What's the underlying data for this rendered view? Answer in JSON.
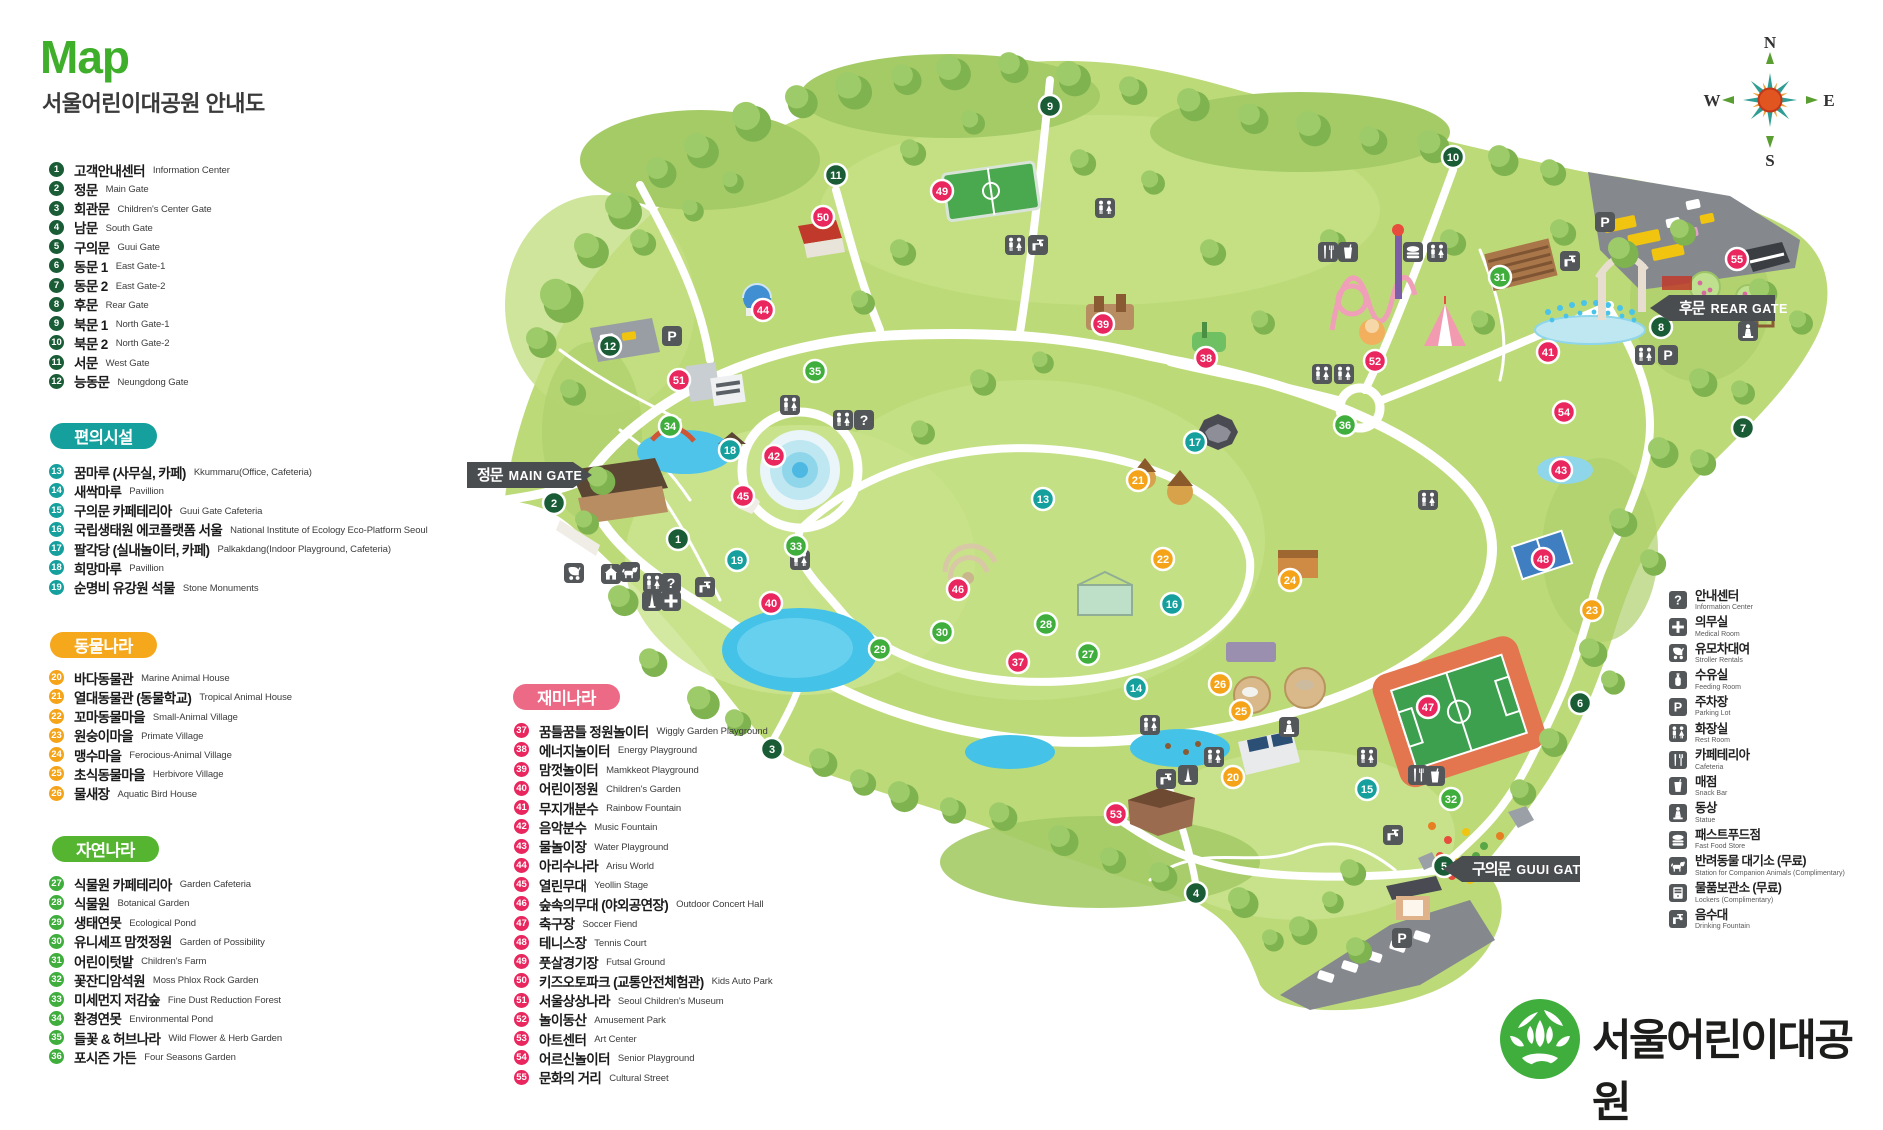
{
  "header": {
    "title": "Map",
    "subtitle": "서울어린이대공원 안내도"
  },
  "logo_text": "서울어린이대공원",
  "compass": {
    "n": "N",
    "e": "E",
    "s": "S",
    "w": "W"
  },
  "icon_glyphs": {
    "question": "?",
    "p": "P"
  },
  "group_colors": {
    "gate": "#1a5c36",
    "conv": "#16a09d",
    "animal": "#f5a41a",
    "nature": "#3fae3c",
    "fun": "#e9265e"
  },
  "sections": [
    {
      "id": "gates",
      "label": null,
      "color": "#1a5c36",
      "items": [
        {
          "n": 1,
          "ko": "고객안내센터",
          "en": "Information Center"
        },
        {
          "n": 2,
          "ko": "정문",
          "en": "Main Gate"
        },
        {
          "n": 3,
          "ko": "회관문",
          "en": "Children's Center Gate"
        },
        {
          "n": 4,
          "ko": "남문",
          "en": "South Gate"
        },
        {
          "n": 5,
          "ko": "구의문",
          "en": "Guui Gate"
        },
        {
          "n": 6,
          "ko": "동문 1",
          "en": "East Gate-1"
        },
        {
          "n": 7,
          "ko": "동문 2",
          "en": "East Gate-2"
        },
        {
          "n": 8,
          "ko": "후문",
          "en": "Rear Gate"
        },
        {
          "n": 9,
          "ko": "북문 1",
          "en": "North Gate-1"
        },
        {
          "n": 10,
          "ko": "북문 2",
          "en": "North Gate-2"
        },
        {
          "n": 11,
          "ko": "서문",
          "en": "West Gate"
        },
        {
          "n": 12,
          "ko": "능동문",
          "en": "Neungdong Gate"
        }
      ]
    },
    {
      "id": "convenience",
      "label": "편의시설",
      "color": "#16a09d",
      "items": [
        {
          "n": 13,
          "ko": "꿈마루 (사무실, 카페)",
          "en": "Kkummaru(Office, Cafeteria)"
        },
        {
          "n": 14,
          "ko": "새싹마루",
          "en": "Pavillion"
        },
        {
          "n": 15,
          "ko": "구의문 카페테리아",
          "en": "Guui Gate Cafeteria"
        },
        {
          "n": 16,
          "ko": "국립생태원 에코플랫폼 서울",
          "en": "National Institute of Ecology Eco-Platform Seoul"
        },
        {
          "n": 17,
          "ko": "팔각당 (실내놀이터, 카페)",
          "en": "Palkakdang(Indoor Playground, Cafeteria)"
        },
        {
          "n": 18,
          "ko": "희망마루",
          "en": "Pavillion"
        },
        {
          "n": 19,
          "ko": "순명비 유강원 석물",
          "en": "Stone Monuments"
        }
      ]
    },
    {
      "id": "animal",
      "label": "동물나라",
      "color": "#f5a81c",
      "items": [
        {
          "n": 20,
          "ko": "바다동물관",
          "en": "Marine Animal House"
        },
        {
          "n": 21,
          "ko": "열대동물관 (동물학교)",
          "en": "Tropical Animal House"
        },
        {
          "n": 22,
          "ko": "꼬마동물마을",
          "en": "Small-Animal Village"
        },
        {
          "n": 23,
          "ko": "원숭이마을",
          "en": "Primate Village"
        },
        {
          "n": 24,
          "ko": "맹수마을",
          "en": "Ferocious-Animal Village"
        },
        {
          "n": 25,
          "ko": "초식동물마을",
          "en": "Herbivore Village"
        },
        {
          "n": 26,
          "ko": "물새장",
          "en": "Aquatic Bird House"
        }
      ]
    },
    {
      "id": "nature",
      "label": "자연나라",
      "color": "#55b531",
      "items": [
        {
          "n": 27,
          "ko": "식물원 카페테리아",
          "en": "Garden Cafeteria"
        },
        {
          "n": 28,
          "ko": "식물원",
          "en": "Botanical Garden"
        },
        {
          "n": 29,
          "ko": "생태연못",
          "en": "Ecological Pond"
        },
        {
          "n": 30,
          "ko": "유니세프 맘껏정원",
          "en": "Garden of Possibility"
        },
        {
          "n": 31,
          "ko": "어린이텃밭",
          "en": "Children's Farm"
        },
        {
          "n": 32,
          "ko": "꽃잔디암석원",
          "en": "Moss Phlox Rock Garden"
        },
        {
          "n": 33,
          "ko": "미세먼지 저감숲",
          "en": "Fine Dust Reduction Forest"
        },
        {
          "n": 34,
          "ko": "환경연못",
          "en": "Environmental Pond"
        },
        {
          "n": 35,
          "ko": "들꽃 & 허브나라",
          "en": "Wild Flower & Herb Garden"
        },
        {
          "n": 36,
          "ko": "포시즌 가든",
          "en": "Four Seasons Garden"
        }
      ]
    },
    {
      "id": "fun",
      "label": "재미나라",
      "color": "#ec6a85",
      "items": [
        {
          "n": 37,
          "ko": "꿈틀꿈틀 정원놀이터",
          "en": "Wiggly Garden Playground"
        },
        {
          "n": 38,
          "ko": "에너지놀이터",
          "en": "Energy Playground"
        },
        {
          "n": 39,
          "ko": "맘껏놀이터",
          "en": "Mamkkeot Playground"
        },
        {
          "n": 40,
          "ko": "어린이정원",
          "en": "Children's Garden"
        },
        {
          "n": 41,
          "ko": "무지개분수",
          "en": "Rainbow Fountain"
        },
        {
          "n": 42,
          "ko": "음악분수",
          "en": "Music Fountain"
        },
        {
          "n": 43,
          "ko": "물놀이장",
          "en": "Water Playground"
        },
        {
          "n": 44,
          "ko": "아리수나라",
          "en": "Arisu World"
        },
        {
          "n": 45,
          "ko": "열린무대",
          "en": "Yeollin Stage"
        },
        {
          "n": 46,
          "ko": "숲속의무대 (야외공연장)",
          "en": "Outdoor Concert Hall"
        },
        {
          "n": 47,
          "ko": "축구장",
          "en": "Soccer Fiend"
        },
        {
          "n": 48,
          "ko": "테니스장",
          "en": "Tennis Court"
        },
        {
          "n": 49,
          "ko": "풋살경기장",
          "en": "Futsal Ground"
        },
        {
          "n": 50,
          "ko": "키즈오토파크 (교통안전체험관)",
          "en": "Kids Auto Park"
        },
        {
          "n": 51,
          "ko": "서울상상나라",
          "en": "Seoul Children's Museum"
        },
        {
          "n": 52,
          "ko": "놀이동산",
          "en": "Amusement Park"
        },
        {
          "n": 53,
          "ko": "아트센터",
          "en": "Art Center"
        },
        {
          "n": 54,
          "ko": "어르신놀이터",
          "en": "Senior Playground"
        },
        {
          "n": 55,
          "ko": "문화의 거리",
          "en": "Cultural Street"
        }
      ]
    }
  ],
  "facility_legend": [
    {
      "icon": "question",
      "ko": "안내센터",
      "en": "Information Center"
    },
    {
      "icon": "plus",
      "ko": "의무실",
      "en": "Medical Room"
    },
    {
      "icon": "stroller",
      "ko": "유모차대여",
      "en": "Stroller Rentals"
    },
    {
      "icon": "bottle",
      "ko": "수유실",
      "en": "Feeding Room"
    },
    {
      "icon": "p",
      "ko": "주차장",
      "en": "Parking Lot"
    },
    {
      "icon": "restroom",
      "ko": "화장실",
      "en": "Rest Room"
    },
    {
      "icon": "utensils",
      "ko": "카페테리아",
      "en": "Cafeteria"
    },
    {
      "icon": "cup",
      "ko": "매점",
      "en": "Snack Bar"
    },
    {
      "icon": "statue",
      "ko": "동상",
      "en": "Statue"
    },
    {
      "icon": "burger",
      "ko": "패스트푸드점",
      "en": "Fast Food Store"
    },
    {
      "icon": "dog",
      "ko": "반려동물 대기소 (무료)",
      "en": "Station for Companion Animals (Complimentary)"
    },
    {
      "icon": "locker",
      "ko": "물품보관소 (무료)",
      "en": "Lockers (Complimentary)"
    },
    {
      "icon": "faucet",
      "ko": "음수대",
      "en": "Drinking Fountain"
    }
  ],
  "map_labels": [
    {
      "ko": "정문",
      "en": "MAIN GATE",
      "x": 467,
      "y": 462,
      "w": 106,
      "arrow": "right"
    },
    {
      "ko": "후문",
      "en": "REAR GATE",
      "x": 1669,
      "y": 295,
      "w": 106,
      "arrow": "left"
    },
    {
      "ko": "구의문",
      "en": "GUUI GATE",
      "x": 1462,
      "y": 856,
      "w": 118,
      "arrow": "left"
    }
  ],
  "markers": [
    {
      "n": 1,
      "x": 678,
      "y": 539,
      "g": "gate"
    },
    {
      "n": 2,
      "x": 554,
      "y": 503,
      "g": "gate"
    },
    {
      "n": 3,
      "x": 772,
      "y": 749,
      "g": "gate"
    },
    {
      "n": 4,
      "x": 1196,
      "y": 893,
      "g": "gate"
    },
    {
      "n": 5,
      "x": 1444,
      "y": 866,
      "g": "gate"
    },
    {
      "n": 6,
      "x": 1580,
      "y": 703,
      "g": "gate"
    },
    {
      "n": 7,
      "x": 1743,
      "y": 428,
      "g": "gate"
    },
    {
      "n": 8,
      "x": 1661,
      "y": 327,
      "g": "gate"
    },
    {
      "n": 9,
      "x": 1050,
      "y": 106,
      "g": "gate"
    },
    {
      "n": 10,
      "x": 1453,
      "y": 157,
      "g": "gate"
    },
    {
      "n": 11,
      "x": 836,
      "y": 175,
      "g": "gate"
    },
    {
      "n": 12,
      "x": 610,
      "y": 346,
      "g": "gate"
    },
    {
      "n": 13,
      "x": 1043,
      "y": 499,
      "g": "conv"
    },
    {
      "n": 14,
      "x": 1136,
      "y": 688,
      "g": "conv"
    },
    {
      "n": 15,
      "x": 1367,
      "y": 789,
      "g": "conv"
    },
    {
      "n": 16,
      "x": 1172,
      "y": 604,
      "g": "conv"
    },
    {
      "n": 17,
      "x": 1195,
      "y": 442,
      "g": "conv"
    },
    {
      "n": 18,
      "x": 730,
      "y": 450,
      "g": "conv"
    },
    {
      "n": 19,
      "x": 737,
      "y": 560,
      "g": "conv"
    },
    {
      "n": 20,
      "x": 1233,
      "y": 777,
      "g": "animal"
    },
    {
      "n": 21,
      "x": 1138,
      "y": 480,
      "g": "animal"
    },
    {
      "n": 22,
      "x": 1163,
      "y": 559,
      "g": "animal"
    },
    {
      "n": 23,
      "x": 1592,
      "y": 610,
      "g": "animal"
    },
    {
      "n": 24,
      "x": 1290,
      "y": 580,
      "g": "animal"
    },
    {
      "n": 25,
      "x": 1241,
      "y": 711,
      "g": "animal"
    },
    {
      "n": 26,
      "x": 1220,
      "y": 684,
      "g": "animal"
    },
    {
      "n": 27,
      "x": 1088,
      "y": 654,
      "g": "nature"
    },
    {
      "n": 28,
      "x": 1046,
      "y": 624,
      "g": "nature"
    },
    {
      "n": 29,
      "x": 880,
      "y": 649,
      "g": "nature"
    },
    {
      "n": 30,
      "x": 942,
      "y": 632,
      "g": "nature"
    },
    {
      "n": 31,
      "x": 1500,
      "y": 277,
      "g": "nature"
    },
    {
      "n": 32,
      "x": 1451,
      "y": 799,
      "g": "nature"
    },
    {
      "n": 33,
      "x": 796,
      "y": 546,
      "g": "nature"
    },
    {
      "n": 34,
      "x": 670,
      "y": 426,
      "g": "nature"
    },
    {
      "n": 35,
      "x": 815,
      "y": 371,
      "g": "nature"
    },
    {
      "n": 36,
      "x": 1345,
      "y": 425,
      "g": "nature"
    },
    {
      "n": 37,
      "x": 1018,
      "y": 662,
      "g": "fun"
    },
    {
      "n": 38,
      "x": 1206,
      "y": 358,
      "g": "fun"
    },
    {
      "n": 39,
      "x": 1103,
      "y": 324,
      "g": "fun"
    },
    {
      "n": 40,
      "x": 771,
      "y": 603,
      "g": "fun"
    },
    {
      "n": 41,
      "x": 1548,
      "y": 352,
      "g": "fun"
    },
    {
      "n": 42,
      "x": 774,
      "y": 456,
      "g": "fun"
    },
    {
      "n": 43,
      "x": 1561,
      "y": 470,
      "g": "fun"
    },
    {
      "n": 44,
      "x": 763,
      "y": 310,
      "g": "fun"
    },
    {
      "n": 45,
      "x": 743,
      "y": 496,
      "g": "fun"
    },
    {
      "n": 46,
      "x": 958,
      "y": 589,
      "g": "fun"
    },
    {
      "n": 47,
      "x": 1428,
      "y": 707,
      "g": "fun"
    },
    {
      "n": 48,
      "x": 1543,
      "y": 559,
      "g": "fun"
    },
    {
      "n": 49,
      "x": 942,
      "y": 191,
      "g": "fun"
    },
    {
      "n": 50,
      "x": 823,
      "y": 217,
      "g": "fun"
    },
    {
      "n": 51,
      "x": 679,
      "y": 380,
      "g": "fun"
    },
    {
      "n": 52,
      "x": 1375,
      "y": 361,
      "g": "fun"
    },
    {
      "n": 53,
      "x": 1116,
      "y": 814,
      "g": "fun"
    },
    {
      "n": 54,
      "x": 1564,
      "y": 412,
      "g": "fun"
    },
    {
      "n": 55,
      "x": 1737,
      "y": 259,
      "g": "fun"
    }
  ],
  "map_icons": [
    {
      "s": "stroller",
      "x": 574,
      "y": 573
    },
    {
      "s": "building",
      "x": 611,
      "y": 574
    },
    {
      "s": "dog",
      "x": 630,
      "y": 572
    },
    {
      "s": "restroom",
      "x": 653,
      "y": 583
    },
    {
      "s": "question",
      "x": 671,
      "y": 583
    },
    {
      "s": "obelisk",
      "x": 652,
      "y": 601
    },
    {
      "s": "plus",
      "x": 671,
      "y": 601
    },
    {
      "s": "faucet",
      "x": 705,
      "y": 587
    },
    {
      "s": "p",
      "x": 672,
      "y": 336
    },
    {
      "s": "restroom",
      "x": 790,
      "y": 405
    },
    {
      "s": "restroom",
      "x": 843,
      "y": 420
    },
    {
      "s": "question",
      "x": 864,
      "y": 420
    },
    {
      "s": "restroom",
      "x": 800,
      "y": 560
    },
    {
      "s": "restroom",
      "x": 1015,
      "y": 245
    },
    {
      "s": "faucet",
      "x": 1038,
      "y": 245
    },
    {
      "s": "restroom",
      "x": 1105,
      "y": 208
    },
    {
      "s": "utensils",
      "x": 1328,
      "y": 252
    },
    {
      "s": "cup",
      "x": 1348,
      "y": 252
    },
    {
      "s": "burger",
      "x": 1413,
      "y": 252
    },
    {
      "s": "restroom",
      "x": 1437,
      "y": 252
    },
    {
      "s": "faucet",
      "x": 1570,
      "y": 261
    },
    {
      "s": "restroom",
      "x": 1322,
      "y": 374
    },
    {
      "s": "restroom",
      "x": 1344,
      "y": 374
    },
    {
      "s": "restroom",
      "x": 1428,
      "y": 500
    },
    {
      "s": "statue",
      "x": 1289,
      "y": 727
    },
    {
      "s": "restroom",
      "x": 1150,
      "y": 725
    },
    {
      "s": "faucet",
      "x": 1166,
      "y": 779
    },
    {
      "s": "obelisk",
      "x": 1188,
      "y": 775
    },
    {
      "s": "restroom",
      "x": 1214,
      "y": 757
    },
    {
      "s": "restroom",
      "x": 1367,
      "y": 757
    },
    {
      "s": "utensils",
      "x": 1418,
      "y": 775
    },
    {
      "s": "cup",
      "x": 1435,
      "y": 776
    },
    {
      "s": "faucet",
      "x": 1393,
      "y": 835
    },
    {
      "s": "restroom",
      "x": 1645,
      "y": 355
    },
    {
      "s": "p",
      "x": 1668,
      "y": 355
    },
    {
      "s": "statue",
      "x": 1748,
      "y": 331
    },
    {
      "s": "p",
      "x": 1605,
      "y": 222
    },
    {
      "s": "p",
      "x": 1402,
      "y": 938
    }
  ],
  "trees": [
    [
      560,
      300,
      20
    ],
    [
      590,
      250,
      16
    ],
    [
      622,
      210,
      17
    ],
    [
      660,
      172,
      14
    ],
    [
      700,
      150,
      16
    ],
    [
      750,
      121,
      18
    ],
    [
      800,
      101,
      15
    ],
    [
      852,
      90,
      17
    ],
    [
      905,
      79,
      14
    ],
    [
      952,
      72,
      16
    ],
    [
      1012,
      67,
      14
    ],
    [
      1072,
      78,
      16
    ],
    [
      1132,
      90,
      13
    ],
    [
      1192,
      104,
      15
    ],
    [
      1252,
      118,
      14
    ],
    [
      1312,
      128,
      16
    ],
    [
      1372,
      140,
      13
    ],
    [
      1432,
      146,
      15
    ],
    [
      1502,
      160,
      14
    ],
    [
      1552,
      172,
      12
    ],
    [
      540,
      342,
      14
    ],
    [
      572,
      392,
      12
    ],
    [
      642,
      242,
      12
    ],
    [
      692,
      210,
      10
    ],
    [
      732,
      182,
      10
    ],
    [
      600,
      480,
      13
    ],
    [
      586,
      522,
      11
    ],
    [
      622,
      600,
      14
    ],
    [
      652,
      662,
      13
    ],
    [
      702,
      702,
      15
    ],
    [
      737,
      722,
      12
    ],
    [
      822,
      762,
      13
    ],
    [
      862,
      782,
      12
    ],
    [
      902,
      796,
      14
    ],
    [
      952,
      810,
      12
    ],
    [
      1002,
      816,
      13
    ],
    [
      1062,
      840,
      14
    ],
    [
      1112,
      860,
      12
    ],
    [
      1162,
      876,
      13
    ],
    [
      1242,
      902,
      14
    ],
    [
      1302,
      930,
      13
    ],
    [
      1358,
      950,
      12
    ],
    [
      1272,
      940,
      10
    ],
    [
      1622,
      252,
      14
    ],
    [
      1682,
      232,
      12
    ],
    [
      1762,
      292,
      13
    ],
    [
      1800,
      322,
      11
    ],
    [
      1702,
      382,
      13
    ],
    [
      1742,
      392,
      11
    ],
    [
      1662,
      452,
      14
    ],
    [
      1702,
      462,
      12
    ],
    [
      1622,
      522,
      13
    ],
    [
      1652,
      562,
      12
    ],
    [
      1592,
      652,
      13
    ],
    [
      1612,
      682,
      11
    ],
    [
      1552,
      742,
      13
    ],
    [
      1522,
      792,
      12
    ],
    [
      1562,
      232,
      12
    ],
    [
      982,
      382,
      12
    ],
    [
      1042,
      362,
      10
    ],
    [
      922,
      432,
      11
    ],
    [
      1262,
      322,
      11
    ],
    [
      1212,
      252,
      12
    ],
    [
      1152,
      182,
      11
    ],
    [
      1082,
      162,
      12
    ],
    [
      902,
      252,
      12
    ],
    [
      862,
      302,
      11
    ],
    [
      1332,
      242,
      12
    ],
    [
      1482,
      322,
      11
    ],
    [
      1452,
      242,
      12
    ],
    [
      1352,
      872,
      12
    ],
    [
      1332,
      902,
      10
    ],
    [
      912,
      152,
      12
    ],
    [
      972,
      122,
      11
    ]
  ],
  "flowers": [
    [
      1432,
      826
    ],
    [
      1448,
      840
    ],
    [
      1466,
      832
    ],
    [
      1484,
      846
    ],
    [
      1500,
      836
    ],
    [
      1440,
      856
    ],
    [
      1458,
      862
    ],
    [
      1476,
      856
    ],
    [
      1494,
      866
    ],
    [
      1452,
      876
    ],
    [
      1470,
      880
    ],
    [
      1488,
      876
    ]
  ]
}
